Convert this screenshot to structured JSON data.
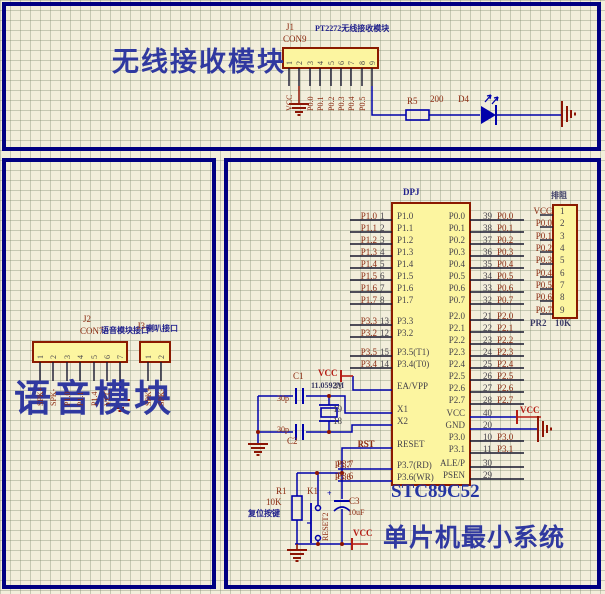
{
  "colors": {
    "wire_blue": "#0000aa",
    "component_yellow": "#fcf5a0",
    "component_border": "#8b1a00",
    "panel_navy": "#000082",
    "net_maroon": "#8c2c12",
    "power_red": "#b41c14",
    "label_navy": "#20208c",
    "title_blue": "#3039a0"
  },
  "titles": {
    "wireless": "无线接收模块",
    "voice": "语音模块",
    "mcu": "单片机最小系统"
  },
  "wireless": {
    "j1_ref": "J1",
    "j1_type": "CON9",
    "j1_label": "PT2272无线接收模块",
    "j1_pins": [
      "1",
      "2",
      "3",
      "4",
      "5",
      "6",
      "7",
      "8",
      "9"
    ],
    "j1_nets": [
      "VCC",
      "",
      "P0.0",
      "P0.1",
      "P0.2",
      "P0.3",
      "P0.4",
      "P0.5",
      ""
    ],
    "r5_ref": "R5",
    "r5_val": "200",
    "d4_ref": "D4"
  },
  "voice": {
    "j2_ref": "J2",
    "j2_type": "CON7",
    "j2_label": "语音模块接口",
    "j2_pins": [
      "1",
      "2",
      "3",
      "4",
      "5",
      "6",
      "7"
    ],
    "j2_nets": [
      "SPK+",
      "SPK-",
      "P1.0",
      "P1.1",
      "P1.4",
      "VCC",
      ""
    ],
    "j3_ref": "J3",
    "j3_label": "喇叭接口",
    "j3_pins": [
      "1",
      "2"
    ],
    "j3_nets": [
      "SPK+",
      "SPK-"
    ]
  },
  "mcu": {
    "designator": "DPJ",
    "part": "STC89C52",
    "vcc": "VCC",
    "rst_net": "RST",
    "p37_net": "P3.7",
    "p36_net": "P3.6",
    "xtal_val": "11.0592M",
    "c1_ref": "C1",
    "c1_val": "30p",
    "c2_ref": "C2",
    "c2_val": "30p",
    "c3_ref": "C3",
    "c3_val": "10uF",
    "c3_plus": "+",
    "r1_ref": "R1",
    "r1_val": "10K",
    "k1_ref": "K1",
    "k1_label": "RESET2",
    "k1_caption": "复位按键",
    "left_rows": [
      {
        "name": "P1.0",
        "num": "1",
        "net": "P1.0"
      },
      {
        "name": "P1.1",
        "num": "2",
        "net": "P1.1"
      },
      {
        "name": "P1.2",
        "num": "3",
        "net": "P1.2"
      },
      {
        "name": "P1.3",
        "num": "4",
        "net": "P1.3"
      },
      {
        "name": "P1.4",
        "num": "5",
        "net": "P1.4"
      },
      {
        "name": "P1.5",
        "num": "6",
        "net": "P1.5"
      },
      {
        "name": "P1.6",
        "num": "7",
        "net": "P1.6"
      },
      {
        "name": "P1.7",
        "num": "8",
        "net": "P1.7"
      },
      {
        "name": "P3.3",
        "num": "13",
        "net": "P3.3"
      },
      {
        "name": "P3.2",
        "num": "12",
        "net": "P3.2"
      },
      {
        "name": "P3.5(T1)",
        "num": "15",
        "net": "P3.5"
      },
      {
        "name": "P3.4(T0)",
        "num": "14",
        "net": "P3.4"
      },
      {
        "name": "EA/VPP",
        "num": "31",
        "net": ""
      },
      {
        "name": "X1",
        "num": "19",
        "net": ""
      },
      {
        "name": "X2",
        "num": "18",
        "net": ""
      },
      {
        "name": "RESET",
        "num": "",
        "net": "RST"
      },
      {
        "name": "P3.7(RD)",
        "num": "",
        "net": "P3.7"
      },
      {
        "name": "P3.6(WR)",
        "num": "",
        "net": "P3.6"
      }
    ],
    "right_rows": [
      {
        "name": "P0.0",
        "num": "39",
        "net": "P0.0"
      },
      {
        "name": "P0.1",
        "num": "38",
        "net": "P0.1"
      },
      {
        "name": "P0.2",
        "num": "37",
        "net": "P0.2"
      },
      {
        "name": "P0.3",
        "num": "36",
        "net": "P0.3"
      },
      {
        "name": "P0.4",
        "num": "35",
        "net": "P0.4"
      },
      {
        "name": "P0.5",
        "num": "34",
        "net": "P0.5"
      },
      {
        "name": "P0.6",
        "num": "33",
        "net": "P0.6"
      },
      {
        "name": "P0.7",
        "num": "32",
        "net": "P0.7"
      },
      {
        "name": "P2.0",
        "num": "21",
        "net": "P2.0"
      },
      {
        "name": "P2.1",
        "num": "22",
        "net": "P2.1"
      },
      {
        "name": "P2.2",
        "num": "23",
        "net": "P2.2"
      },
      {
        "name": "P2.3",
        "num": "24",
        "net": "P2.3"
      },
      {
        "name": "P2.4",
        "num": "25",
        "net": "P2.4"
      },
      {
        "name": "P2.5",
        "num": "26",
        "net": "P2.5"
      },
      {
        "name": "P2.6",
        "num": "27",
        "net": "P2.6"
      },
      {
        "name": "P2.7",
        "num": "28",
        "net": "P2.7"
      },
      {
        "name": "VCC",
        "num": "40",
        "net": ""
      },
      {
        "name": "GND",
        "num": "20",
        "net": ""
      },
      {
        "name": "P3.0",
        "num": "10",
        "net": "P3.0"
      },
      {
        "name": "P3.1",
        "num": "11",
        "net": "P3.1"
      },
      {
        "name": "ALE/P",
        "num": "30",
        "net": ""
      },
      {
        "name": "PSEN",
        "num": "29",
        "net": ""
      }
    ],
    "resnet": {
      "label": "排阻",
      "ref": "PR2",
      "val": "10K",
      "pins": [
        "1",
        "2",
        "3",
        "4",
        "5",
        "6",
        "7",
        "8",
        "9"
      ],
      "nets": [
        "VCC",
        "P0.0",
        "P0.1",
        "P0.2",
        "P0.3",
        "P0.4",
        "P0.5",
        "P0.6",
        "P0.7"
      ]
    }
  }
}
